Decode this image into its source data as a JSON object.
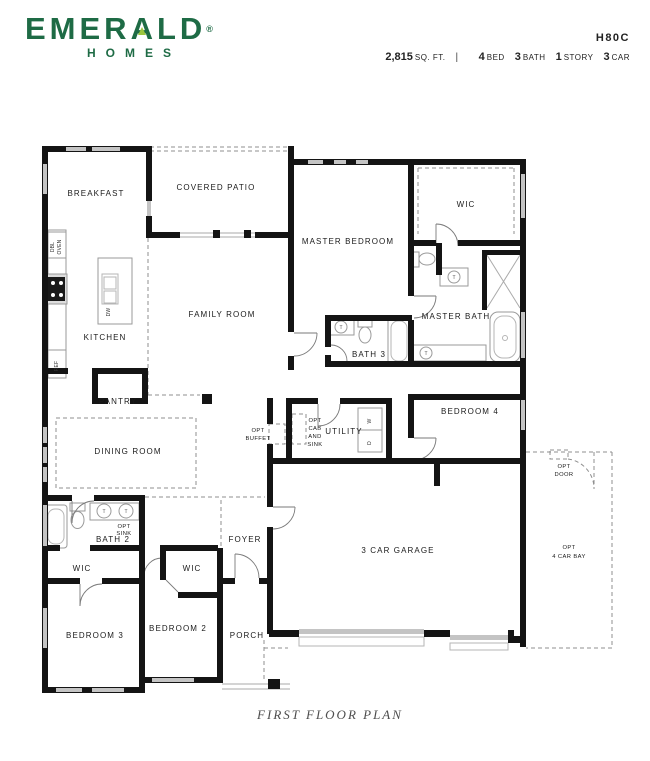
{
  "header": {
    "brand_pre": "EMER",
    "brand_a": "A",
    "brand_post": "LD",
    "registered": "®",
    "brand_sub": "HOMES",
    "plan_code": "H80C",
    "sqft_value": "2,815",
    "sqft_unit": "SQ. FT.",
    "divider": "|",
    "specs": [
      {
        "num": "4",
        "label": "BED"
      },
      {
        "num": "3",
        "label": "BATH"
      },
      {
        "num": "1",
        "label": "STORY"
      },
      {
        "num": "3",
        "label": "CAR"
      }
    ]
  },
  "rooms": {
    "breakfast": "BREAKFAST",
    "covered_patio": "COVERED PATIO",
    "master_bedroom": "MASTER BEDROOM",
    "wic_master": "WIC",
    "kitchen": "KITCHEN",
    "family_room": "FAMILY ROOM",
    "master_bath": "MASTER BATH",
    "bath3": "BATH 3",
    "pantry": "PANTRY",
    "dining_room": "DINING ROOM",
    "utility": "UTILITY",
    "bedroom4": "BEDROOM 4",
    "bath2": "BATH 2",
    "wic_bed3": "WIC",
    "wic_bed2": "WIC",
    "foyer": "FOYER",
    "garage": "3 CAR GARAGE",
    "bedroom3": "BEDROOM 3",
    "bedroom2": "BEDROOM 2",
    "porch": "PORCH"
  },
  "annotations": {
    "opt_buffet": [
      "OPT",
      "BUFFET"
    ],
    "opt_cab_sink": [
      "OPT",
      "CAB",
      "AND",
      "SINK"
    ],
    "opt_sink": [
      "OPT",
      "SINK"
    ],
    "opt_door": [
      "OPT",
      "DOOR"
    ],
    "opt_4car": [
      "OPT",
      "4 CAR BAY"
    ],
    "dbl_oven": [
      "DBL",
      "OVEN"
    ],
    "ref": "REF",
    "dw": "DW",
    "washer": "W",
    "dryer": "D",
    "faucet": "T"
  },
  "footer": {
    "caption": "FIRST FLOOR PLAN"
  },
  "colors": {
    "brand_green": "#1e6b45",
    "accent_green": "#9bc53d",
    "wall_black": "#141414",
    "window_gray": "#c4c4c4",
    "fixture_gray": "#9a9a9a",
    "dash_gray": "#8f8f8f",
    "label_dark": "#1b1b1b",
    "caption_gray": "#4e4e4e"
  }
}
